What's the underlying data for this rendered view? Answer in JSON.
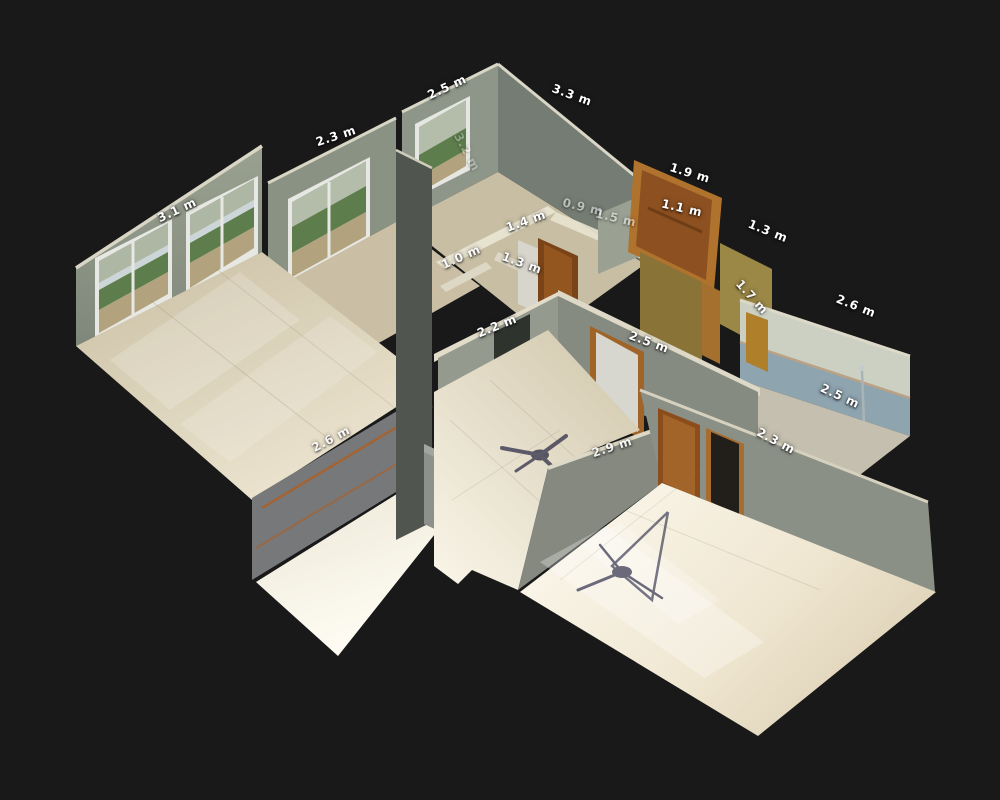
{
  "viewer": {
    "type": "dollhouse-3d-floorplan",
    "unit": "m",
    "background_color": "#191919",
    "label_color": "#ffffff",
    "palette": {
      "wall_light": "#99a18f",
      "wall_medium": "#868b82",
      "wall_dark": "#50564f",
      "wall_cut_edge": "#e2ddca",
      "floor_beige": "#cfc5aa",
      "floor_bright": "#f8f4e7",
      "door_wood": "#8d5020",
      "door_frame": "#b0732e",
      "bathroom_tile": "#8ea4af",
      "window_trees": "#5e7d4c",
      "tripod_shadow": "#3a3a52"
    },
    "measurements": [
      {
        "label": "3.1 m",
        "x": 177,
        "y": 210,
        "rot": -25,
        "opacity": 1
      },
      {
        "label": "2.3 m",
        "x": 336,
        "y": 136,
        "rot": -18,
        "opacity": 1
      },
      {
        "label": "2.5 m",
        "x": 447,
        "y": 87,
        "rot": -25,
        "opacity": 1
      },
      {
        "label": "3.3 m",
        "x": 572,
        "y": 95,
        "rot": 20,
        "opacity": 1
      },
      {
        "label": "1.9 m",
        "x": 690,
        "y": 173,
        "rot": 17,
        "opacity": 1
      },
      {
        "label": "1.1 m",
        "x": 682,
        "y": 208,
        "rot": 13,
        "opacity": 1
      },
      {
        "label": "1.3 m",
        "x": 768,
        "y": 231,
        "rot": 22,
        "opacity": 1
      },
      {
        "label": "1.4 m",
        "x": 526,
        "y": 221,
        "rot": -20,
        "opacity": 1
      },
      {
        "label": "0.9 m",
        "x": 583,
        "y": 207,
        "rot": 13,
        "opacity": 0.5
      },
      {
        "label": "1.5 m",
        "x": 616,
        "y": 218,
        "rot": 13,
        "opacity": 0.5
      },
      {
        "label": "1.0 m",
        "x": 461,
        "y": 257,
        "rot": -24,
        "opacity": 0.85
      },
      {
        "label": "1.3 m",
        "x": 522,
        "y": 263,
        "rot": 20,
        "opacity": 0.95
      },
      {
        "label": "1.7 m",
        "x": 752,
        "y": 297,
        "rot": 48,
        "opacity": 0.9
      },
      {
        "label": "2.6 m",
        "x": 856,
        "y": 306,
        "rot": 22,
        "opacity": 1
      },
      {
        "label": "2.2 m",
        "x": 497,
        "y": 326,
        "rot": -22,
        "opacity": 1
      },
      {
        "label": "2.5 m",
        "x": 649,
        "y": 342,
        "rot": 20,
        "opacity": 1
      },
      {
        "label": "2.5 m",
        "x": 840,
        "y": 396,
        "rot": 25,
        "opacity": 1
      },
      {
        "label": "2.3 m",
        "x": 776,
        "y": 441,
        "rot": 28,
        "opacity": 1
      },
      {
        "label": "2.6 m",
        "x": 331,
        "y": 439,
        "rot": -28,
        "opacity": 0.8
      },
      {
        "label": "2.9 m",
        "x": 612,
        "y": 447,
        "rot": -18,
        "opacity": 0.85
      },
      {
        "label": "3.2 m",
        "x": 467,
        "y": 152,
        "rot": 62,
        "opacity": 0.3
      }
    ]
  }
}
